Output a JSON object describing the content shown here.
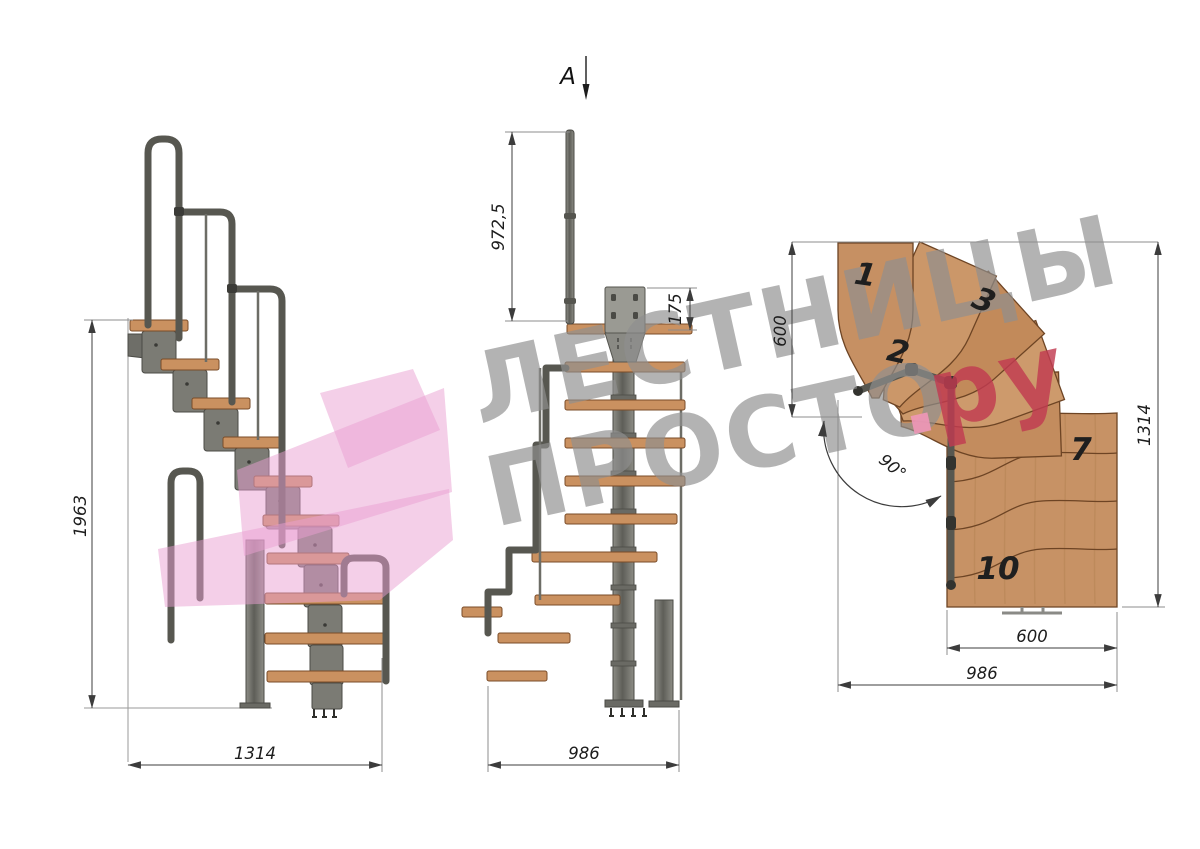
{
  "watermark": {
    "line1": "ЛЕСТНИЦЫ",
    "line2": "ПРОСТО",
    "suffix_dot": ".",
    "suffix": "ру",
    "text_color": "#8f8f8f",
    "suffix_color": "#c13a50",
    "dot_color": "#ef97b8",
    "logo_color": "#e99fd2"
  },
  "section_marker": {
    "label": "A"
  },
  "views": {
    "side": {
      "name": "side-elevation",
      "dim_height": "1963",
      "dim_width": "1314"
    },
    "front": {
      "name": "front-elevation",
      "dim_rail_height": "972,5",
      "dim_bracket_height": "175",
      "dim_width": "986"
    },
    "plan": {
      "name": "plan-view",
      "dim_flight_depth": "600",
      "dim_total_depth": "1314",
      "dim_step_width": "600",
      "dim_total_width": "986",
      "dim_turn_angle": "90°",
      "steps": [
        {
          "label": "1"
        },
        {
          "label": "2"
        },
        {
          "label": "3"
        },
        {
          "label": "7"
        },
        {
          "label": "10"
        }
      ]
    }
  },
  "colors": {
    "wood": "#c79265",
    "wood_dark_edge": "#6d4424",
    "metal": "#7b7b74",
    "metal_dark": "#4b4b46",
    "rail": "#575750",
    "dimension_line": "#3c3c3c",
    "text": "#1d1d1d"
  }
}
